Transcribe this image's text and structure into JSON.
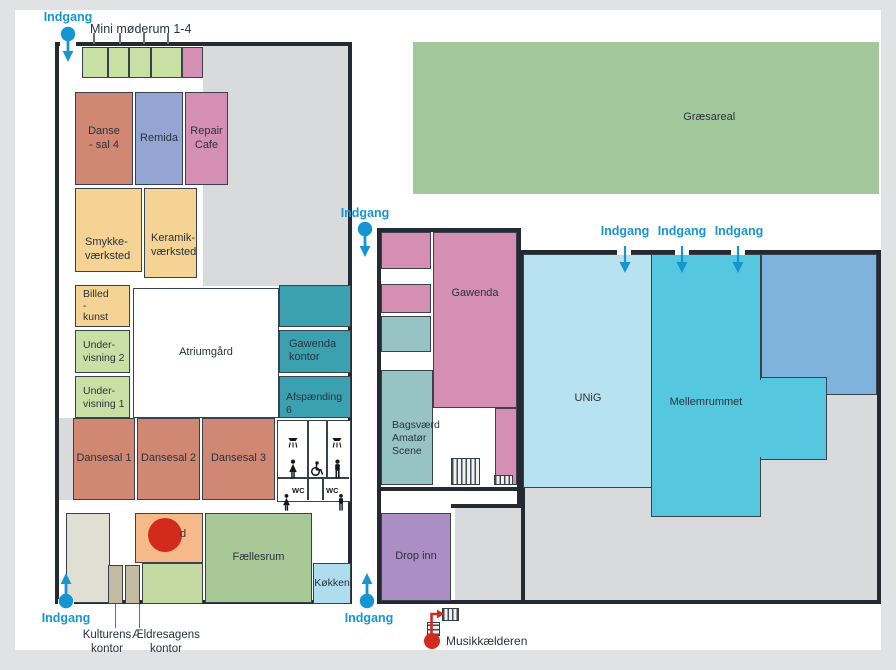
{
  "palette": {
    "page_bg": "#e1e2e4",
    "canvas_bg": "#ffffff",
    "building_grey": "#d8dadc",
    "wall": "#252a32",
    "entrance_blue": "#1795d3",
    "marker_red": "#d22b1e",
    "text_dark": "#2a333c",
    "salmon": "#d08773",
    "pink": "#d58fb2",
    "periwinkle": "#95a5d3",
    "tan": "#f5d395",
    "light_green": "#c9e0a5",
    "teal_dark": "#3ba1b1",
    "teal_muted": "#97c3c5",
    "orange": "#f5ba88",
    "faellesrum_green": "#a9c897",
    "pale_green": "#c5daa2",
    "kitchen_blue": "#aedded",
    "beige": "#e0dfd3",
    "kontor_tan": "#c3bba1",
    "purple": "#ab8ec4",
    "unig_blue": "#b8e2ef",
    "cyan": "#55c8e0",
    "steel_blue": "#7fb3de",
    "grass_green": "#a3c89b"
  },
  "labels": {
    "indgang": "Indgang",
    "mini_moderum": "Mini møderum 1-4",
    "danse_sal_4": "Danse\n- sal 4",
    "remida": "Remida",
    "repair_cafe": "Repair\nCafe",
    "smykke": "Smykke-\nværksted",
    "keramik": "Keramik-\nværksted",
    "billedkunst": "Billed\n-\nkunst",
    "undervisning_2": "Under-\nvisning 2",
    "undervisning_1": "Under-\nvisning 1",
    "atriumgaard": "Atriumgård",
    "gawenda_kontor": "Gawenda\nkontor",
    "afspaending_6": "Afspænding 6",
    "dansesal_1": "Dansesal 1",
    "dansesal_2": "Dansesal 2",
    "dansesal_3": "Dansesal 3",
    "wc": "WC",
    "billard_partial": "d",
    "faellesrum": "Fællesrum",
    "koekken": "Køkken",
    "kulturens_kontor": "Kulturens\nkontor",
    "aeldresagens_kontor": "Ældresagens\nkontor",
    "gawenda": "Gawenda",
    "bagsvaerd_amatoer_scene": "Bagsværd\nAmatør\nScene",
    "drop_inn": "Drop inn",
    "unig": "UNiG",
    "mellemrummet": "Mellemrummet",
    "graesareal": "Græsareal",
    "musikkaelderen": "Musikkælderen"
  }
}
